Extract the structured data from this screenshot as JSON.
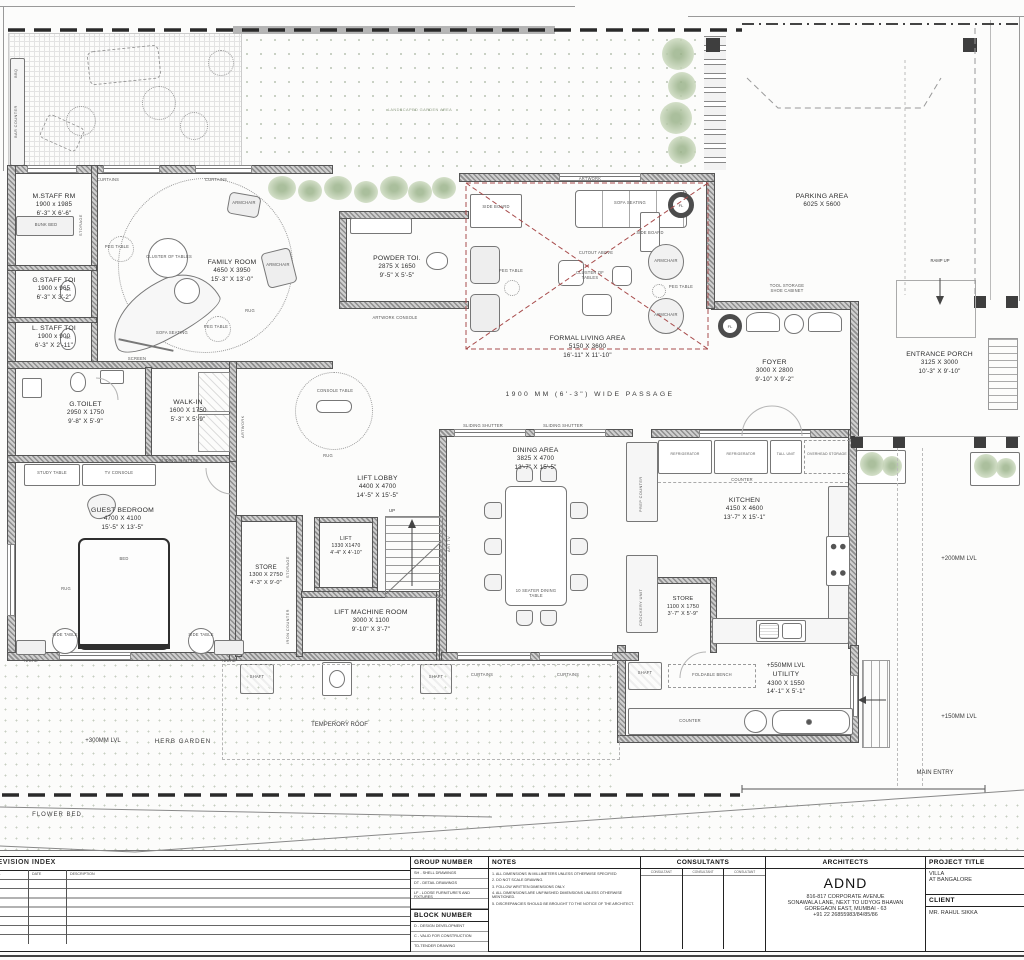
{
  "drawing": {
    "rooms": [
      {
        "name": "M.STAFF RM",
        "mm": "1900 x 1985",
        "ft": "6'-3\" X 6'-6\""
      },
      {
        "name": "G.STAFF TOI",
        "mm": "1900 x 965",
        "ft": "6'-3\" X 3'-2\""
      },
      {
        "name": "L. STAFF TOI",
        "mm": "1900 x 900",
        "ft": "6'-3\" X 2'-11\""
      },
      {
        "name": "FAMILY ROOM",
        "mm": "4650 X 3950",
        "ft": "15'-3\" X 13'-0\""
      },
      {
        "name": "POWDER TOI.",
        "mm": "2875 X 1650",
        "ft": "9'-5\" X 5'-5\""
      },
      {
        "name": "FORMAL LIVING AREA",
        "mm": "5150 X 3600",
        "ft": "16'-11\" X 11'-10\""
      },
      {
        "name": "FOYER",
        "mm": "3000 X 2800",
        "ft": "9'-10\" X 9'-2\""
      },
      {
        "name": "ENTRANCE PORCH",
        "mm": "3125 X 3000",
        "ft": "10'-3\" X 9'-10\""
      },
      {
        "name": "PARKING AREA",
        "mm": "6025 X 5600",
        "ft": ""
      },
      {
        "name": "G.TOILET",
        "mm": "2950 X 1750",
        "ft": "9'-8\" X 5'-9\""
      },
      {
        "name": "WALK-IN",
        "mm": "1600 X 1750",
        "ft": "5'-3\" X 5'-9\""
      },
      {
        "name": "GUEST BEDROOM",
        "mm": "4700 X 4100",
        "ft": "15'-5\" X 13'-5\""
      },
      {
        "name": "LIFT LOBBY",
        "mm": "4400 X 4700",
        "ft": "14'-5\" X 15'-5\""
      },
      {
        "name": "LIFT",
        "mm": "1330 X1470",
        "ft": "4'-4\" X 4'-10\""
      },
      {
        "name": "STORE",
        "mm": "1300 X 2750",
        "ft": "4'-3\" X 9'-0\""
      },
      {
        "name": "LIFT MACHINE ROOM",
        "mm": "3000 X 1100",
        "ft": "9'-10\" X 3'-7\""
      },
      {
        "name": "DINING AREA",
        "mm": "3825 X 4700",
        "ft": "13'-7\" X 15'-5\""
      },
      {
        "name": "KITCHEN",
        "mm": "4150 X 4600",
        "ft": "13'-7\" X 15'-1\""
      },
      {
        "name": "STORE",
        "mm": "1100 X 1750",
        "ft": "3'-7\" X 5'-9\""
      },
      {
        "name": "UTILITY",
        "mm": "4300 X 1550",
        "ft": "14'-1\" X 5'-1\""
      }
    ],
    "annotations": {
      "landscaped_garden": "LANDSCAPED GARDEN AREA",
      "passage": "1900 MM (6'-3\") WIDE PASSAGE",
      "herb_garden_level": "+300MM LVL",
      "herb_garden": "HERB GARDEN",
      "flower_bed": "FLOWER BED",
      "temp_roof": "TEMPERORY ROOF",
      "main_entry": "MAIN ENTRY",
      "lvl_200": "+200MM LVL",
      "lvl_150": "+150MM LVL",
      "lvl_550": "+550MM LVL",
      "ramp_up": "RAMP UP",
      "up": "UP"
    },
    "labels": {
      "bar_counter": "BAR COUNTER",
      "bbq": "BBQ",
      "curtains": "CURTAINS",
      "sliding_shutter": "SLIDING SHUTTER",
      "sofa_seating": "SOFA SEATING",
      "cluster_of_tables": "CLUSTER OF TABLES",
      "peg_table": "PEG TABLE",
      "armchair": "ARMCHAIR",
      "rug": "RUG",
      "screen": "SCREEN",
      "bunk_bed": "BUNK BED",
      "storage": "STORAGE",
      "side_board": "SIDE BOARD",
      "artwork": "ARTWORK",
      "artwork_console": "ARTWORK CONSOLE",
      "cutout_above": "CUTOUT ABOVE",
      "console_table": "CONSOLE TABLE",
      "study_table": "STUDY TABLE",
      "tv_console": "TV CONSOLE",
      "bed": "BED",
      "side_table": "SIDE TABLE",
      "niche": "NICHE",
      "tool_storage": "TOOL STORAGE",
      "shoe_cabinet": "SHOE CABINET",
      "prep_counter": "PREP COUNTER",
      "refrigerator": "REFRIGERATOR",
      "tall_unit": "TALL UNIT",
      "overhead_storage": "OVERHEAD STORAGE",
      "counter": "COUNTER",
      "crockery_unit": "CROCKERY UNIT",
      "foldable_bench": "FOLDABLE BENCH",
      "dining_table": "10 SEATER DINING TABLE",
      "art_tv": "ART TV",
      "iron_counter": "IRON COUNTER",
      "shaft": "SHAFT",
      "wc": "WC",
      "fl": "FL"
    }
  },
  "title_block": {
    "revision": {
      "title": "REVISION INDEX",
      "col_rev": "REV NO.",
      "col_date": "DATE",
      "col_desc": "DESCRIPTION"
    },
    "group_number": {
      "title": "GROUP NUMBER",
      "items": [
        "SH - SHELL DRAWINGS",
        "DT - DETAIL DRAWINGS",
        "LF - LOOSE FURNITURE'S AND FIXTURES"
      ]
    },
    "block_number": {
      "title": "BLOCK NUMBER",
      "items": [
        "D - DESIGN DEVELOPMENT",
        "C - VALID FOR CONSTRUCTION",
        "TD-TENDER DRAWING"
      ]
    },
    "notes": {
      "title": "NOTES",
      "items": [
        "1. ALL DIMENSIONS IN MILLIMETERS UNLESS OTHERWISE SPECIFIED",
        "2. DO NOT SCALE DRAWING.",
        "3. FOLLOW WRITTEN DIMENSIONS ONLY.",
        "4. ALL DIMENSIONS ARE UNFINISHED DIMENSIONS UNLESS OTHERWISE MENTIONED.",
        "5. DISCREPANCIES SHOULD BE BROUGHT TO THE NOTICE OF THE ARCHITECT."
      ]
    },
    "consultants": {
      "title": "CONSULTANTS",
      "cols": [
        "CONSULTANT",
        "CONSULTANT",
        "CONSULTANT"
      ]
    },
    "architects": {
      "title": "ARCHITECTS",
      "name": "ADND",
      "address1": "816-817 CORPORATE AVENUE",
      "address2": "SONAWALA LANE, NEXT TO UDYOG BHAVAN",
      "address3": "GOREGAON EAST, MUMBAI - 63",
      "phone": "+91 22 26855983/84/85/86"
    },
    "project": {
      "title": "PROJECT TITLE",
      "line1": "VILLA",
      "line2": "AT BANGALORE"
    },
    "client": {
      "title": "CLIENT",
      "name": "MR. RAHUL SIKKA"
    }
  }
}
